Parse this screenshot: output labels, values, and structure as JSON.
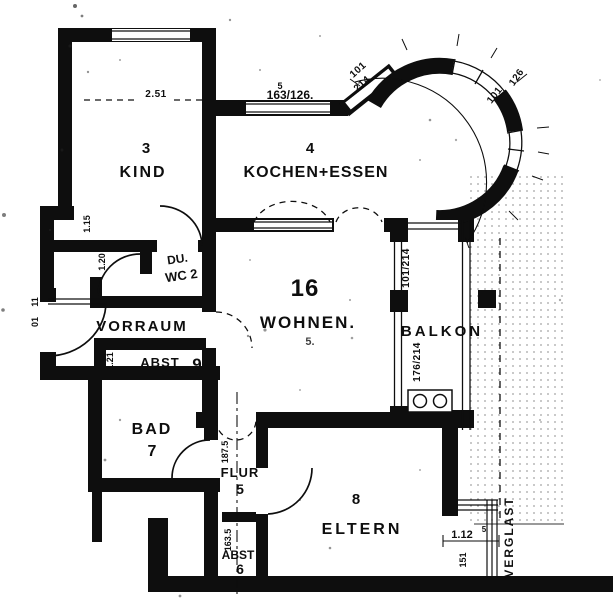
{
  "colors": {
    "ink": "#161616",
    "paper": "#fcfcfc"
  },
  "plan": {
    "rooms": {
      "kind": {
        "number": "3",
        "name": "KIND"
      },
      "kochen": {
        "number": "4",
        "name": "KOCHEN+ESSEN"
      },
      "wohnen": {
        "number": "16",
        "name": "WOHNEN.",
        "sub": "5."
      },
      "balkon": {
        "name": "BALKON"
      },
      "vorraum": {
        "name": "VORRAUM"
      },
      "duwc": {
        "line1": "DU.",
        "line2": "WC 2"
      },
      "abst9": {
        "name": "ABST",
        "number": "9"
      },
      "bad": {
        "name": "BAD",
        "number": "7"
      },
      "flur": {
        "name": "FLUR",
        "number": "5"
      },
      "abst6": {
        "name": "ABST",
        "number": "6"
      },
      "eltern": {
        "number": "8",
        "name": "ELTERN"
      },
      "glazing": {
        "label": "VERGLAST"
      }
    },
    "dims": {
      "kind_top": "2.51",
      "side_a": "1.15",
      "side_b": "1.20",
      "abst9_left": "1.21",
      "entrance_a": "11",
      "entrance_b": "01",
      "kitchen_mark": "5",
      "kitchen_window": "163/126.",
      "diag_a": "101",
      "diag_b": "214",
      "bay_a": "101",
      "bay_b": "126",
      "balcony_door": "101/214",
      "balcony_window": "176/214",
      "flur_a": "187.5",
      "flur_b": "163.5",
      "eltern_a": "1.12",
      "eltern_sup": "5",
      "eltern_b": "151"
    }
  }
}
